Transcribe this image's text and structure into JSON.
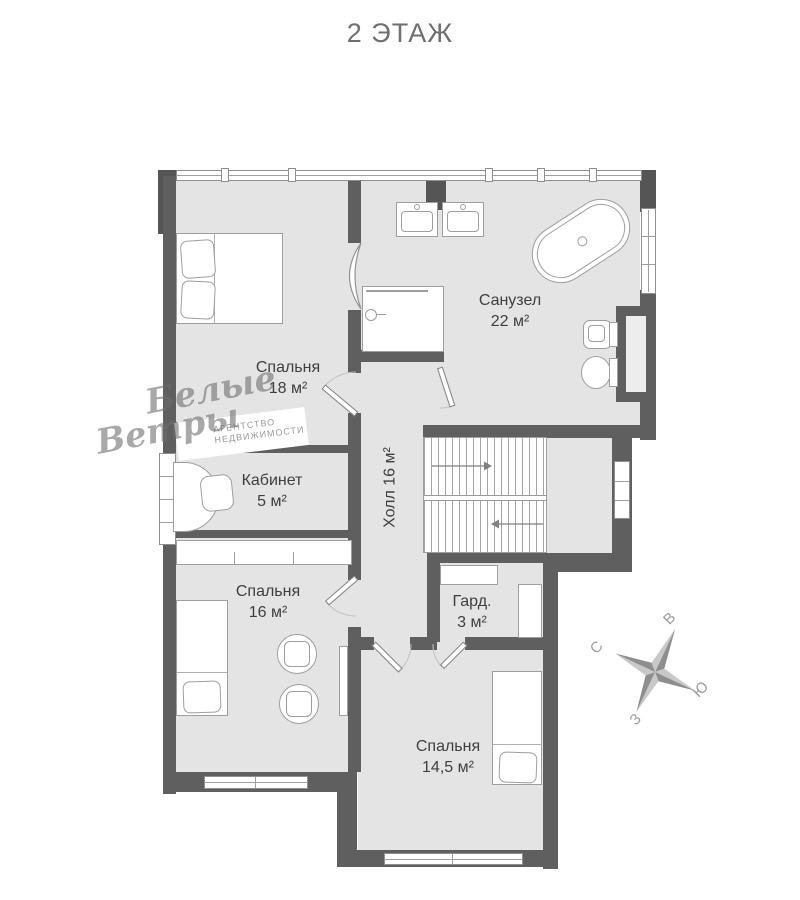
{
  "title": "2 ЭТАЖ",
  "rooms": {
    "bedroom18": {
      "name": "Спальня",
      "area": "18 м²"
    },
    "bathroom": {
      "name": "Санузел",
      "area": "22 м²"
    },
    "office": {
      "name": "Кабинет",
      "area": "5 м²"
    },
    "hall": {
      "label": "Холл 16 м²"
    },
    "bedroom16": {
      "name": "Спальня",
      "area": "16 м²"
    },
    "wardrobe": {
      "name": "Гард.",
      "area": "3 м²"
    },
    "bedroom14": {
      "name": "Спальня",
      "area": "14,5 м²"
    }
  },
  "compass": {
    "north": "С",
    "east": "В",
    "south": "Ю",
    "west": "З"
  },
  "watermark": {
    "script_line1": "Белые",
    "script_line2": "Ветры",
    "agency_line1": "АГЕНТСТВО",
    "agency_line2": "НЕДВИЖИМОСТИ"
  },
  "colors": {
    "wall": "#5f5f5f",
    "floor": "#e4e4e4",
    "furniture_outline": "#9e9e9e",
    "label_text": "#3f3f3f",
    "title_text": "#6f6f6f",
    "watermark": "#9a9a9a"
  }
}
